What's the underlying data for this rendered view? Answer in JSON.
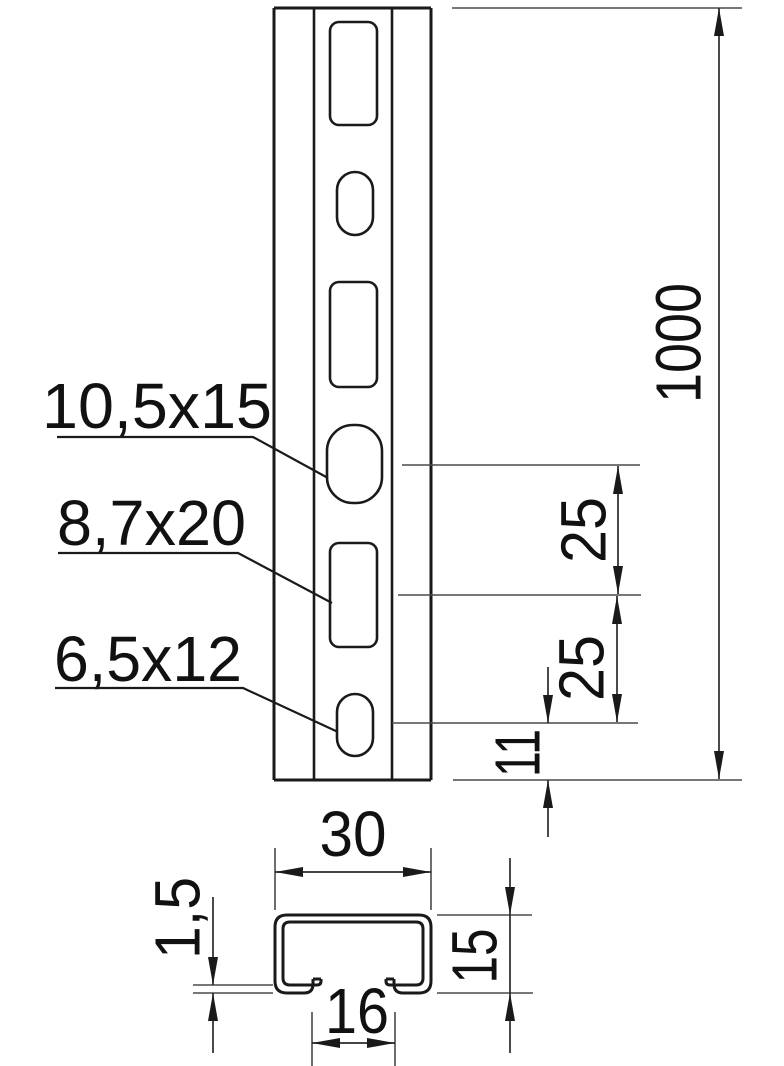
{
  "drawing": {
    "labels": {
      "hole_round": "10,5x15",
      "hole_slot": "8,7x20",
      "hole_oval": "6,5x12"
    },
    "dims": {
      "length": "1000",
      "pitch_a": "25",
      "pitch_b": "25",
      "end_offset": "11",
      "profile_width": "30",
      "profile_height": "15",
      "opening_width": "16",
      "material_thickness": "1,5"
    },
    "colors": {
      "line": "#1a1a1a",
      "background": "#ffffff"
    }
  }
}
